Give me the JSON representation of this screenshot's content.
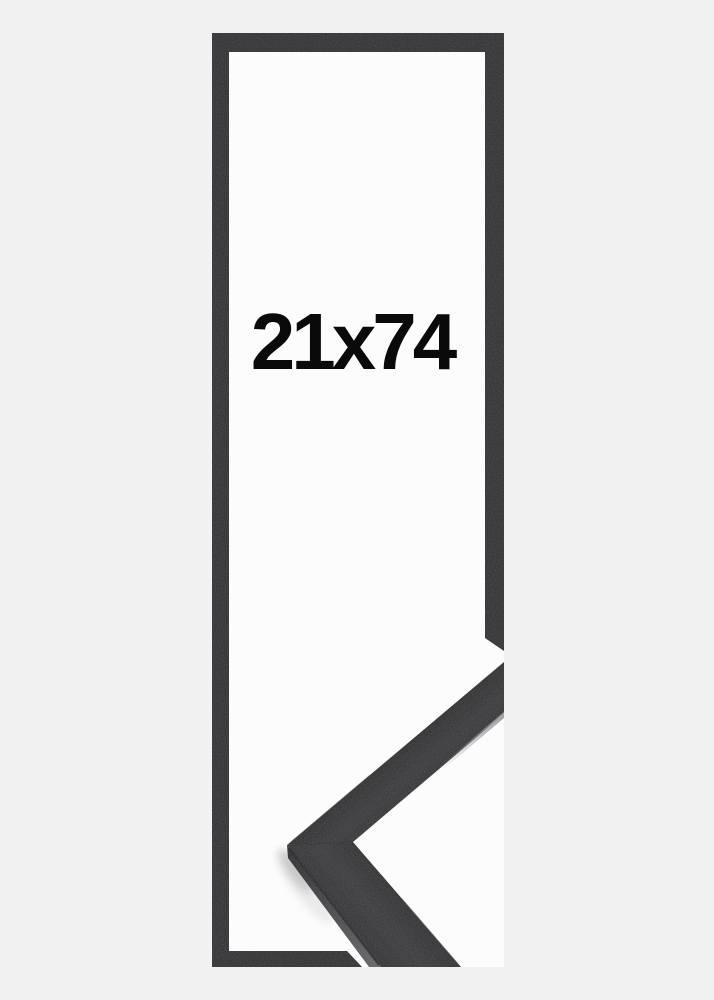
{
  "product_image": {
    "size_label": "21x74",
    "frame_color_name": "black"
  },
  "colors": {
    "background": "#f1f1f2",
    "frame_backing": "#fcfcfd",
    "frame_outline": "#2e2e31",
    "moulding_top_surface": "#343437",
    "moulding_side_face_light": "#636366",
    "moulding_side_face_dark": "#27272a",
    "moulding_edge_highlight": "#a0a0a4",
    "label_text": "#0a0a0a"
  }
}
